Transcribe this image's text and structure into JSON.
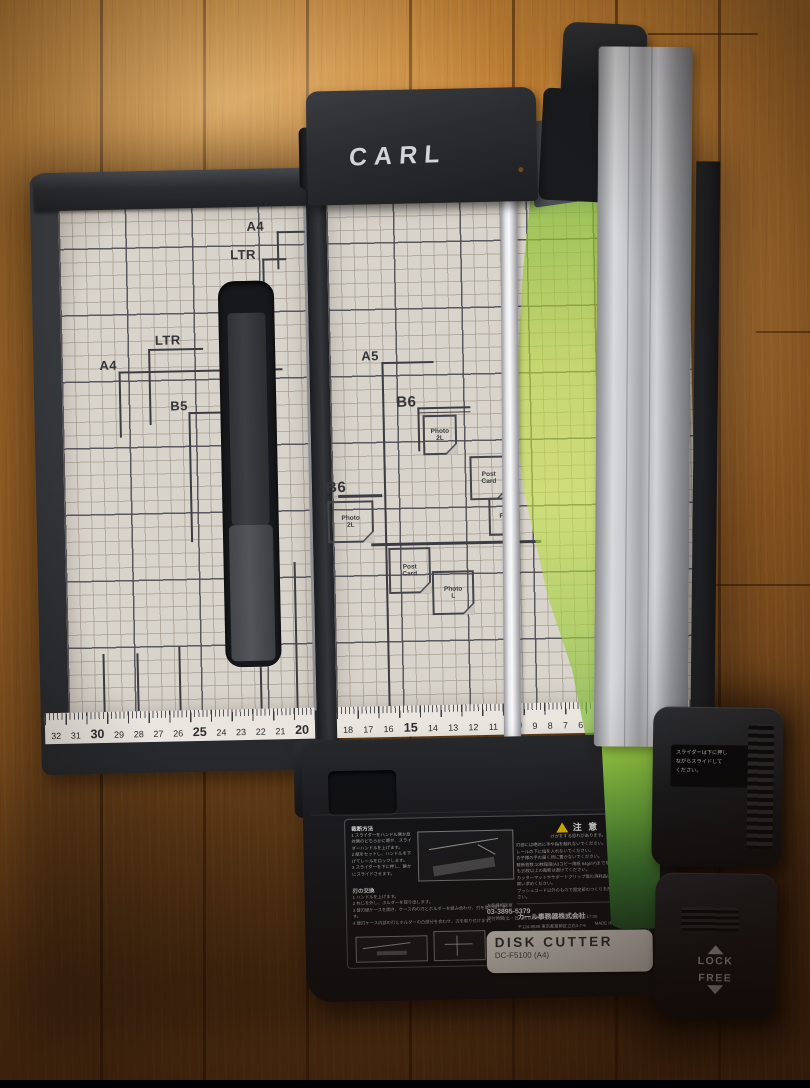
{
  "device": {
    "brand": "CARL",
    "product_label": {
      "title": "DISK CUTTER",
      "model": "DC-F5100 (A4)"
    },
    "slider_caution": {
      "l1": "スライダーは下に押し",
      "l2": "ながらスライドして",
      "l3": "ください。"
    },
    "lock_label": "LOCK",
    "free_label": "FREE"
  },
  "cutting_mat": {
    "wing_marks": {
      "a4_top": "A4",
      "ltr_top": "LTR",
      "ltr_mid": "LTR",
      "a4_mid": "A4",
      "b5": "B5"
    },
    "main_marks": {
      "a5": "A5",
      "b6_upper": "B6",
      "b6_lower": "B6",
      "photo_2l_upper": {
        "w1": "Photo",
        "w2": "2L"
      },
      "photo_2l_lower": {
        "w1": "Photo",
        "w2": "2L"
      },
      "post_card_upper": {
        "w1": "Post",
        "w2": "Card"
      },
      "post_card_lower": {
        "w1": "Post",
        "w2": "Card"
      },
      "photo_l": {
        "w1": "Photo",
        "w2": "L"
      },
      "photo_hidden": "Ph"
    },
    "ruler_wing": [
      "32",
      "31",
      "30",
      "29",
      "28",
      "27",
      "26",
      "25",
      "24",
      "23",
      "22",
      "21",
      "20"
    ],
    "ruler_main": [
      "18",
      "17",
      "16",
      "15",
      "14",
      "13",
      "12",
      "11",
      "10",
      "9",
      "8",
      "7",
      "6",
      "5",
      "4",
      "3"
    ]
  },
  "info_label": {
    "cut_method_title": "裁断方法",
    "cut_steps": [
      "1 スライダーをハンドル側か反対側のどちらかに寄せ、スライダーハンドルを上げます。",
      "2 紙をセットし、ハンドルを下げてレールをロックします。",
      "3 スライダーを下に押し、静かにスライドさせます。"
    ],
    "blade_title": "刃の交換",
    "blade_steps": [
      "1 ハンドルを上げます。",
      "2 ねじを外し、ホルダーを取り出します。",
      "3 替刃紙ケースを開き、ケース内の刃とホルダーを組み合わせ、刃を取り出します。",
      "4 替刃ケース内部の刃とホルダーの凸部分を合わせ、刃を取り付けます。"
    ],
    "warning_title": "注 意",
    "warning_sub": "けがをする恐れがあります。",
    "warning_items": [
      "刃部には絶対に手や指を触れないでください。",
      "レールの下に指を入れないでください。",
      "お子様の手の届く所に置かないでください。",
      "裁断枚数:10枚程度(A3コピー用紙 64g/m²)までを目安に、薄紙でも15枚以上の裁断は避けてください。",
      "カッターマットやサポートグリップ等の消耗品は、お早めにお買い求めください。",
      "ブッシュコード以外のもので固定部のつくりを改造しないでください。"
    ],
    "company": "カール事務器株式会社",
    "address": "〒124-8588  東京都葛飾区立石3-7-9",
    "url": "http://www.carl.co.jp",
    "support": "お客様相談室",
    "phone": "03-3895-5379",
    "hours": "受付時間(土・日・祝日を除く) 9:00〜12:00/13:00〜17:00",
    "made_in": "MADE IN CHINA"
  },
  "colors": {
    "press_sheet_green": "#b8d43c",
    "mat": "#d8d3cb",
    "plastic": "#26282c",
    "wood": "#b5742e"
  }
}
